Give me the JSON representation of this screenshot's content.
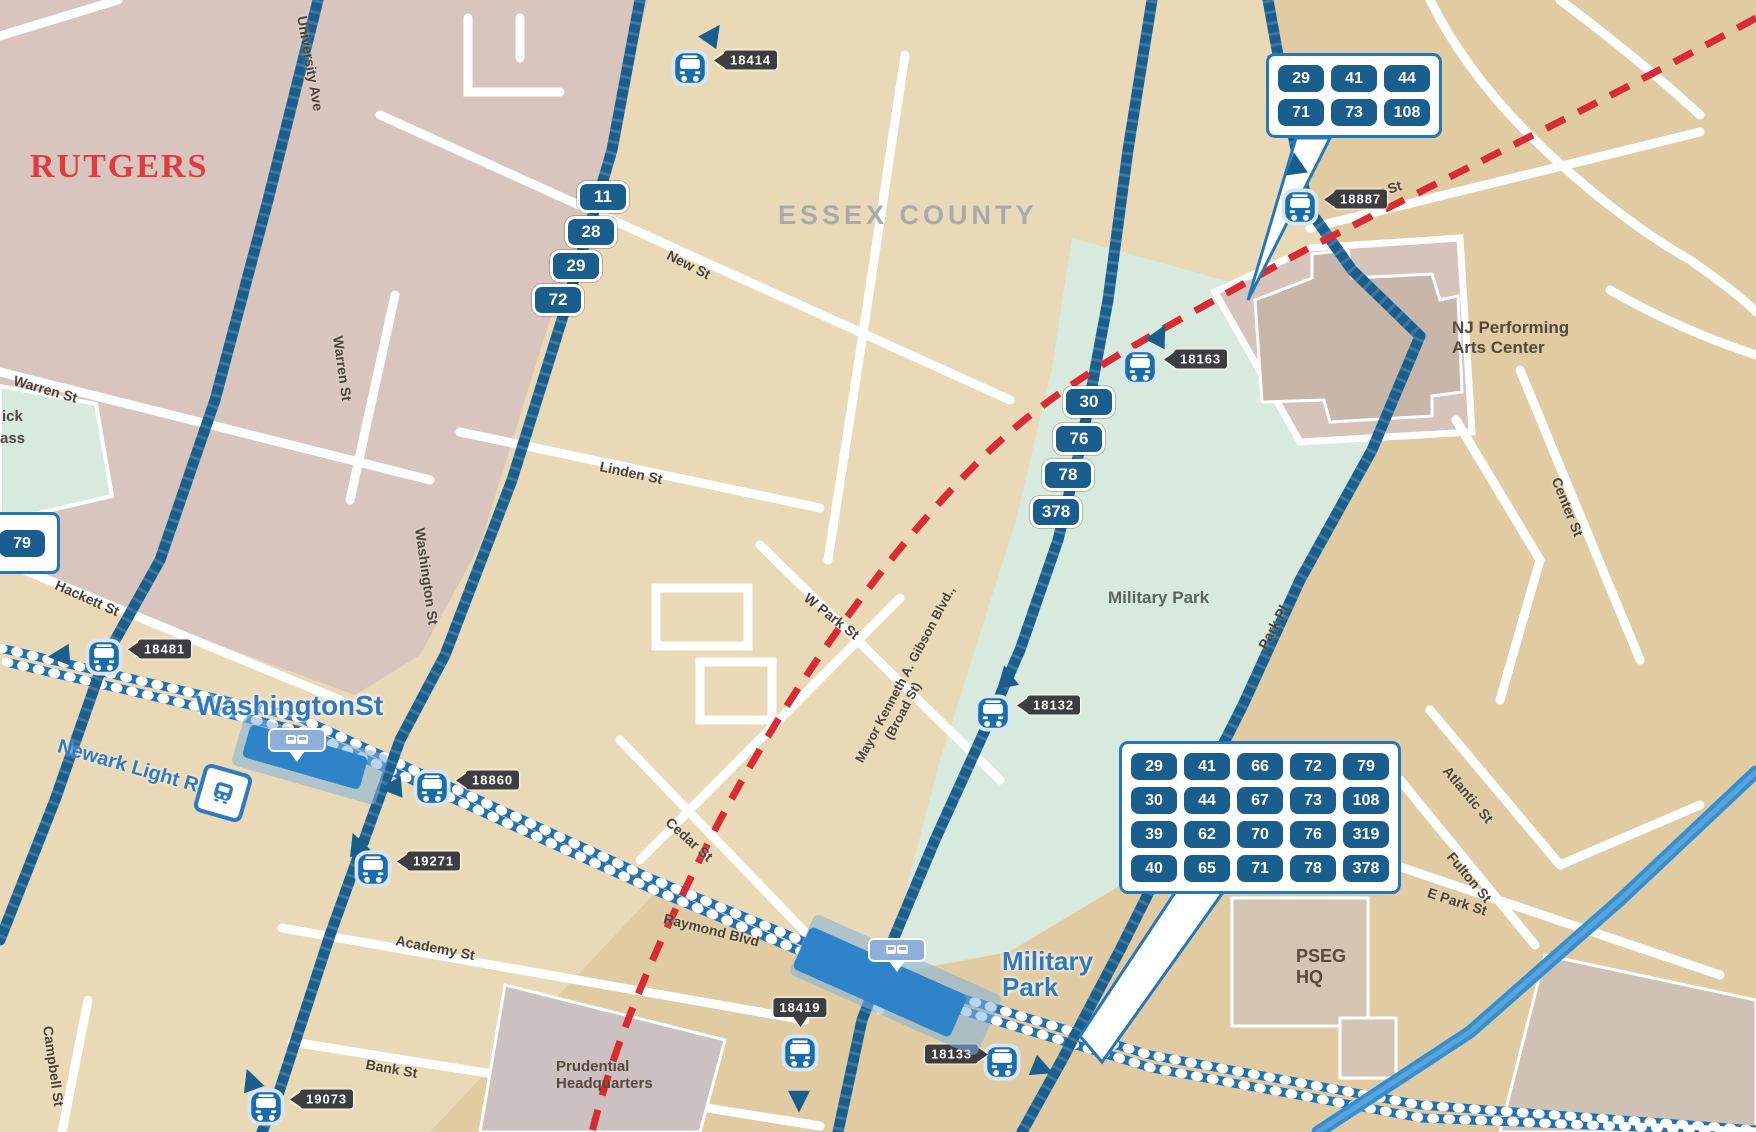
{
  "title": "Newark downtown transit map detail",
  "colors": {
    "route_blue": "#1a5e8e",
    "light_rail_blue": "#2171b5",
    "bright_rail": "#338fd0",
    "red_boundary": "#da2a33",
    "tan": "#e9d9b6",
    "dark_tan": "#e0cba2",
    "mauve": "#d8c5be",
    "park_green": "#d8e9dd",
    "station_text": "#2e79c0",
    "tag_gray": "#3e3e40",
    "rutgers_red": "#e23a3f"
  },
  "map": {
    "region_labels": {
      "university": "RUTGERS",
      "county": "ESSEX COUNTY"
    },
    "place_labels": [
      {
        "name": "njpac",
        "lines": "NJ Performing\nArts Center",
        "x": 1452,
        "y": 318,
        "fs": 17
      },
      {
        "name": "military-park-green",
        "lines": "Military Park",
        "x": 1108,
        "y": 588,
        "fs": 17
      },
      {
        "name": "pseg-hq",
        "lines": "PSEG\nHQ",
        "x": 1296,
        "y": 946,
        "fs": 18
      },
      {
        "name": "prudential-hq",
        "lines": "Prudential\nHeadquarters",
        "x": 556,
        "y": 1058,
        "fs": 15
      }
    ],
    "street_labels": [
      {
        "text": "University Ave",
        "x": 302,
        "y": 8,
        "rot": 80
      },
      {
        "text": "Warren St",
        "x": 14,
        "y": 372,
        "rot": 16
      },
      {
        "text": "Warren St",
        "x": 338,
        "y": 328,
        "rot": 82
      },
      {
        "text": "New St",
        "x": 668,
        "y": 246,
        "rot": 27
      },
      {
        "text": "Linden St",
        "x": 600,
        "y": 458,
        "rot": 12
      },
      {
        "text": "Washington St",
        "x": 420,
        "y": 520,
        "rot": 82
      },
      {
        "text": "Hackett St",
        "x": 56,
        "y": 576,
        "rot": 24
      },
      {
        "text": "W Park St",
        "x": 806,
        "y": 588,
        "rot": 38
      },
      {
        "text": "Cedar St",
        "x": 668,
        "y": 812,
        "rot": 42
      },
      {
        "text": "Raymond Blvd",
        "x": 664,
        "y": 910,
        "rot": 14
      },
      {
        "text": "Academy St",
        "x": 396,
        "y": 932,
        "rot": 11
      },
      {
        "text": "Bank St",
        "x": 366,
        "y": 1056,
        "rot": 10
      },
      {
        "text": "Campbell St",
        "x": 48,
        "y": 1018,
        "rot": 82
      },
      {
        "text": "Park Pl",
        "x": 1272,
        "y": 46,
        "rot": 78
      },
      {
        "text": "Park Pl",
        "x": 1262,
        "y": 640,
        "rot": -62
      },
      {
        "text": "Rector St",
        "x": 1342,
        "y": 196,
        "rot": -18
      },
      {
        "text": "Center St",
        "x": 1556,
        "y": 470,
        "rot": 68
      },
      {
        "text": "Atlantic St",
        "x": 1446,
        "y": 760,
        "rot": 50
      },
      {
        "text": "Fulton St",
        "x": 1450,
        "y": 846,
        "rot": 50
      },
      {
        "text": "E Park St",
        "x": 1428,
        "y": 884,
        "rot": 18
      }
    ],
    "broad_label": {
      "line1": "Mayor Kenneth A. Gibson Blvd.,",
      "line2": "(Broad St)",
      "x": 852,
      "y": 758,
      "rot": -62
    },
    "partial_labels": [
      {
        "text": "ick",
        "x": 2,
        "y": 408
      },
      {
        "text": "ass",
        "y": 430,
        "x": 0
      }
    ],
    "route_badges": [
      {
        "v": "11",
        "x": 603,
        "y": 197
      },
      {
        "v": "28",
        "x": 591,
        "y": 232
      },
      {
        "v": "29",
        "x": 576,
        "y": 266
      },
      {
        "v": "72",
        "x": 558,
        "y": 300
      },
      {
        "v": "30",
        "x": 1089,
        "y": 402
      },
      {
        "v": "76",
        "x": 1079,
        "y": 439
      },
      {
        "v": "78",
        "x": 1068,
        "y": 475
      },
      {
        "v": "378",
        "x": 1056,
        "y": 512
      }
    ],
    "callouts": [
      {
        "name": "npac-routes",
        "x": 1266,
        "y": 53,
        "rows": [
          [
            "29",
            "41",
            "44"
          ],
          [
            "71",
            "73",
            "108"
          ]
        ]
      },
      {
        "name": "military-park-routes",
        "x": 1119,
        "y": 741,
        "rows": [
          [
            "29",
            "41",
            "66",
            "72",
            "79"
          ],
          [
            "30",
            "44",
            "67",
            "73",
            "108"
          ],
          [
            "39",
            "62",
            "70",
            "76",
            "319"
          ],
          [
            "40",
            "65",
            "71",
            "78",
            "378"
          ]
        ]
      }
    ],
    "edge_callout": {
      "badge": "79"
    },
    "stations": [
      {
        "name": "WashingtonSt",
        "lx": 196,
        "ly": 692,
        "fs": 28,
        "badge": {
          "x": 268,
          "y": 728
        },
        "platform": {
          "x": 305,
          "y": 757,
          "w": 122,
          "h": 34,
          "rot": 16
        },
        "band": {
          "x": 310,
          "y": 760,
          "w": 150,
          "h": 52,
          "rot": 16
        }
      },
      {
        "name": "Military\nPark",
        "lx": 1002,
        "ly": 948,
        "fs": 26,
        "badge": {
          "x": 868,
          "y": 938
        },
        "platform": {
          "x": 880,
          "y": 982,
          "w": 172,
          "h": 46,
          "rot": 24
        },
        "band": {
          "x": 895,
          "y": 985,
          "w": 205,
          "h": 66,
          "rot": 24
        }
      }
    ],
    "light_rail": {
      "label": "Newark Light Rail",
      "x": 58,
      "y": 735,
      "rot": 16,
      "icon_x": 198,
      "icon_y": 768
    },
    "bus_stops": [
      {
        "id": "18414",
        "x": 690,
        "y": 68,
        "side": "left",
        "tx": 714,
        "ty": 60,
        "ax": 700,
        "ay": 22,
        "arot": 35
      },
      {
        "id": "18887",
        "x": 1300,
        "y": 207,
        "side": "left",
        "tx": 1324,
        "ty": 199,
        "ax": 1285,
        "ay": 152,
        "arot": -8
      },
      {
        "id": "18163",
        "x": 1140,
        "y": 367,
        "side": "left",
        "tx": 1164,
        "ty": 359,
        "ax": 1147,
        "ay": 323,
        "arot": 28
      },
      {
        "id": "18132",
        "x": 993,
        "y": 713,
        "side": "left",
        "tx": 1017,
        "ty": 705,
        "ax": 996,
        "ay": 665,
        "arot": -10
      },
      {
        "id": "18481",
        "x": 104,
        "y": 657,
        "side": "left",
        "tx": 128,
        "ty": 649,
        "ax": 52,
        "ay": 640,
        "arot": -95
      },
      {
        "id": "18860",
        "x": 432,
        "y": 788,
        "side": "left",
        "tx": 456,
        "ty": 780,
        "ax": 384,
        "ay": 772,
        "arot": -95
      },
      {
        "id": "19271",
        "x": 373,
        "y": 869,
        "side": "left",
        "tx": 397,
        "ty": 861,
        "ax": 347,
        "ay": 832,
        "arot": -20
      },
      {
        "id": "19073",
        "x": 266,
        "y": 1107,
        "side": "left",
        "tx": 290,
        "ty": 1099,
        "ax": 241,
        "ay": 1068,
        "arot": -20
      },
      {
        "id": "18419",
        "x": 800,
        "y": 1053,
        "side": "down",
        "tx": 800,
        "ty": 998,
        "ax": 788,
        "ay": 1082,
        "arot": 180
      },
      {
        "id": "18133",
        "x": 1002,
        "y": 1062,
        "side": "right",
        "tx": 925,
        "ty": 1054,
        "ax": 1028,
        "ay": 1052,
        "arot": 112
      }
    ]
  }
}
